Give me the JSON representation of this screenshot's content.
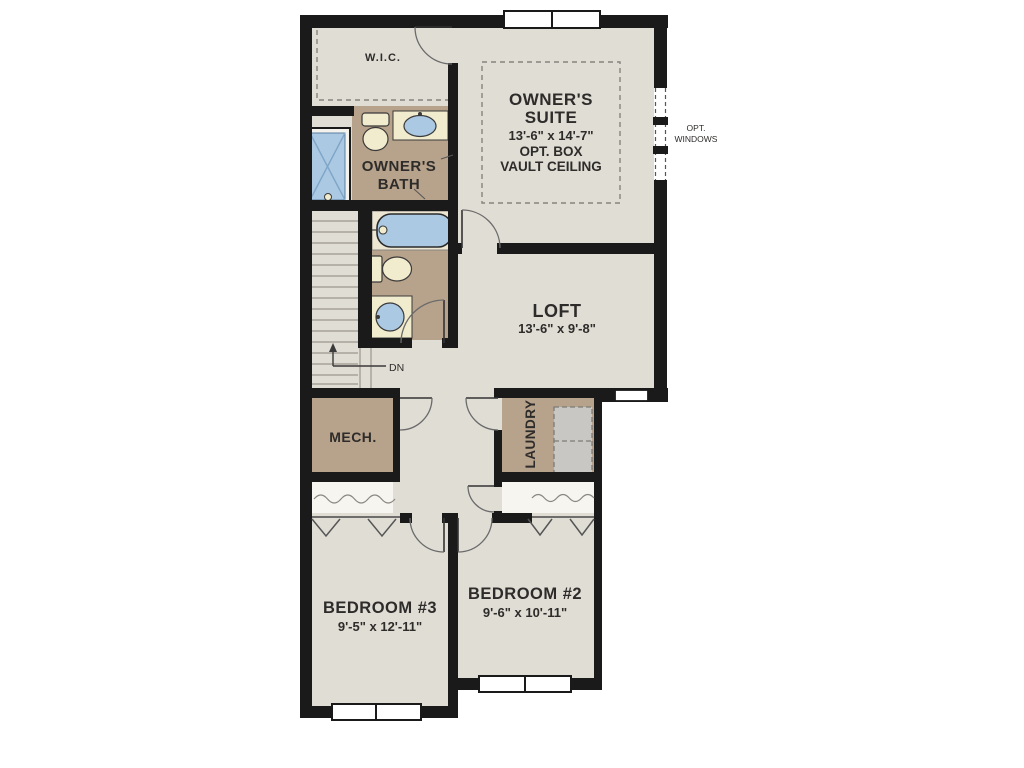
{
  "colors": {
    "wall": "#1a1a1a",
    "floor": "#e0ddd5",
    "room_accent_brown": "#b7a28b",
    "fixture_blue": "#abc9e3",
    "fixture_cream": "#f2ecce",
    "tub_deck_cream": "#ece6d2",
    "appliance_gray": "#c8c7c3",
    "canvas": "#ffffff"
  },
  "rooms": {
    "wic": {
      "label": "W.I.C."
    },
    "owners_suite": {
      "line1": "OWNER'S",
      "line2": "SUITE",
      "dims": "13'-6\" x 14'-7\"",
      "note1": "OPT. BOX",
      "note2": "VAULT CEILING"
    },
    "owners_bath": {
      "line1": "OWNER'S",
      "line2": "BATH"
    },
    "loft": {
      "label": "LOFT",
      "dims": "13'-6\" x 9'-8\""
    },
    "mech": {
      "label": "MECH."
    },
    "laundry": {
      "label": "LAUNDRY"
    },
    "bedroom3": {
      "label": "BEDROOM #3",
      "dims": "9'-5\" x 12'-11\""
    },
    "bedroom2": {
      "label": "BEDROOM #2",
      "dims": "9'-6\" x 10'-11\""
    }
  },
  "annotations": {
    "stairs_down": "DN",
    "opt_windows_line1": "OPT.",
    "opt_windows_line2": "WINDOWS"
  }
}
